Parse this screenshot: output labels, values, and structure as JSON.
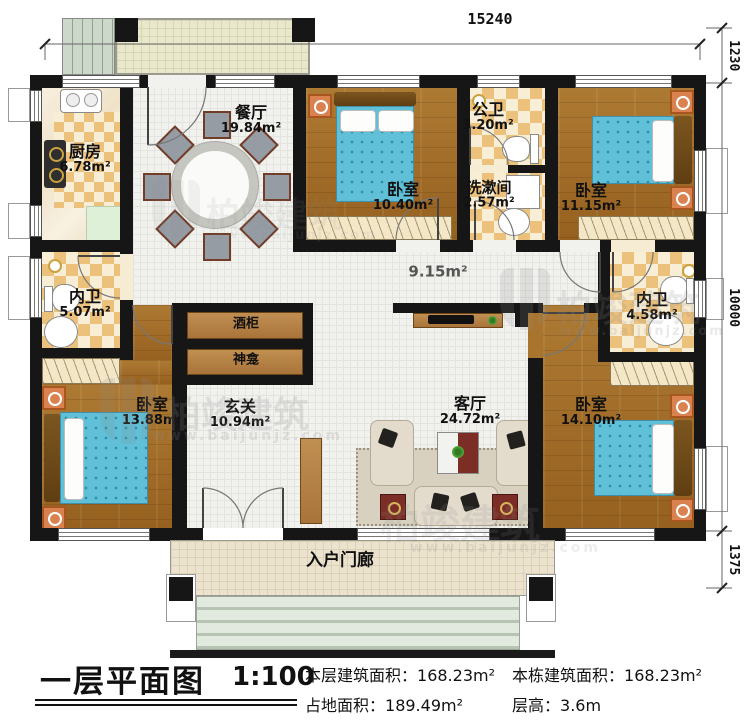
{
  "dimensions": {
    "top": "15240",
    "right_top": "1230",
    "right_mid": "10000",
    "right_bottom": "1375"
  },
  "rooms": {
    "kitchen": {
      "name": "厨房",
      "area": "6.78m²"
    },
    "dining": {
      "name": "餐厅",
      "area": "19.84m²"
    },
    "bedroom_top_left": {
      "name": "卧室",
      "area": "10.40m²"
    },
    "public_bath": {
      "name": "公卫",
      "area": "3.20m²"
    },
    "washroom": {
      "name": "洗漱间",
      "area": "2.57m²"
    },
    "bedroom_top_right": {
      "name": "卧室",
      "area": "11.15m²"
    },
    "bath_left": {
      "name": "内卫",
      "area": "5.07m²"
    },
    "bath_right": {
      "name": "内卫",
      "area": "4.58m²"
    },
    "bedroom_bottom_left": {
      "name": "卧室",
      "area": "13.88m²"
    },
    "foyer": {
      "name": "玄关",
      "area": "10.94m²"
    },
    "living": {
      "name": "客厅",
      "area": "24.72m²"
    },
    "bedroom_bottom_right": {
      "name": "卧室",
      "area": "14.10m²"
    },
    "corridor": {
      "area": "9.15m²"
    },
    "porch": {
      "name": "入户门廊"
    },
    "wine_cabinet": {
      "name": "酒柜"
    },
    "shrine": {
      "name": "神龛"
    }
  },
  "titleblock": {
    "title": "一层平面图",
    "scale": "1:100",
    "stats": [
      {
        "label": "本层建筑面积：",
        "value": "168.23m²"
      },
      {
        "label": "占地面积：",
        "value": "189.49m²"
      },
      {
        "label": "本栋建筑面积：",
        "value": "168.23m²"
      },
      {
        "label": "层高：",
        "value": "3.6m"
      }
    ]
  },
  "watermark": {
    "brand": "柏竣建筑",
    "url": "www.baijunjz.com"
  }
}
